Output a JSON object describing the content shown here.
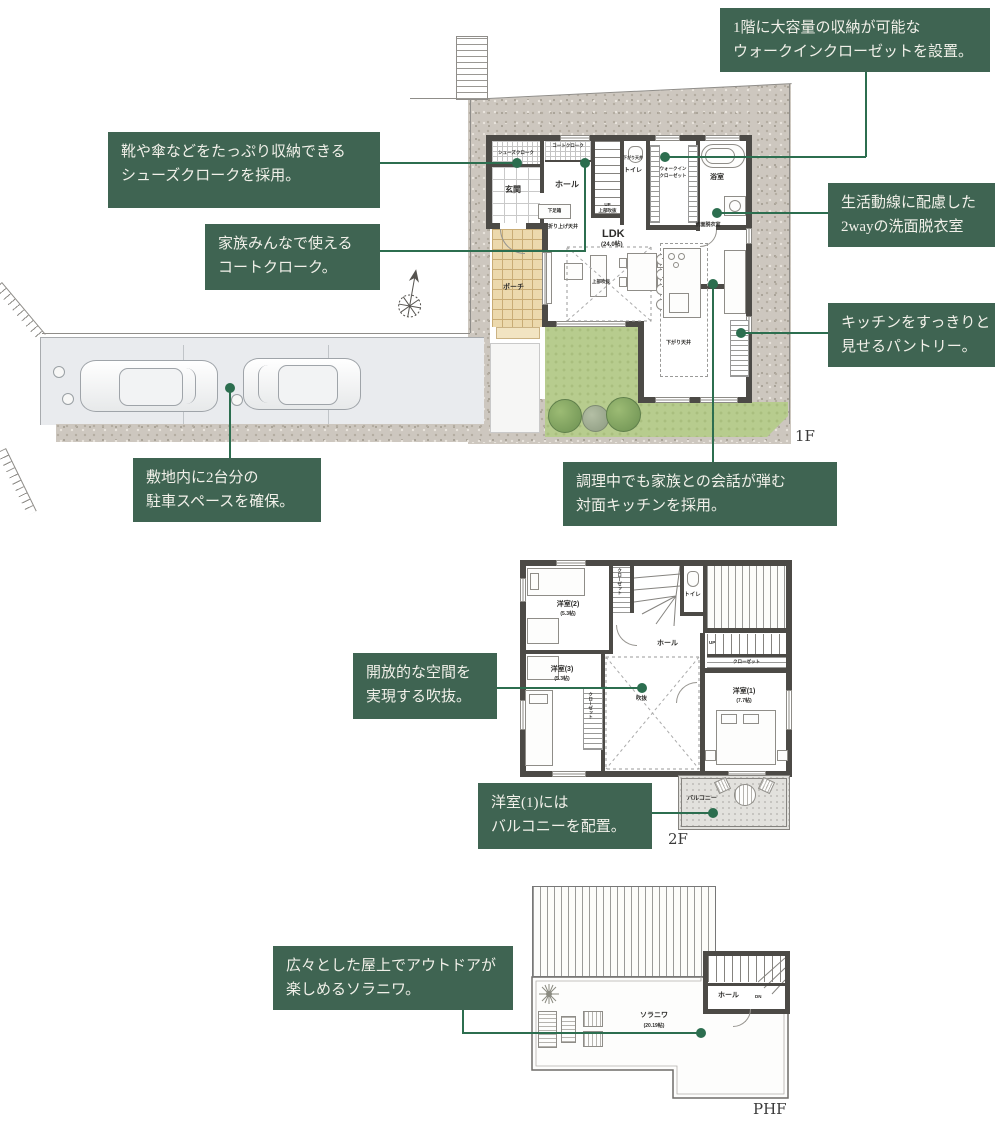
{
  "colors": {
    "accent_green": "#3f6452",
    "line_green": "#2c6e4f",
    "wall": "#4c4a46",
    "lawn": "#b7cc8e"
  },
  "annotations": {
    "walkin": {
      "l1": "1階に大容量の収納が可能な",
      "l2": "ウォークインクローゼットを設置。"
    },
    "shoes": {
      "l1": "靴や傘などをたっぷり収納できる",
      "l2": "シューズクロークを採用。"
    },
    "coat": {
      "l1": "家族みんなで使える",
      "l2": "コートクローク。"
    },
    "washroom": {
      "l1": "生活動線に配慮した",
      "l2": "2wayの洗面脱衣室"
    },
    "pantry": {
      "l1": "キッチンをすっきりと",
      "l2": "見せるパントリー。"
    },
    "parking": {
      "l1": "敷地内に2台分の",
      "l2": "駐車スペースを確保。"
    },
    "kitchen": {
      "l1": "調理中でも家族との会話が弾む",
      "l2": "対面キッチンを採用。"
    },
    "void": {
      "l1": "開放的な空間を",
      "l2": "実現する吹抜。"
    },
    "balcony": {
      "l1": "洋室(1)には",
      "l2": "バルコニーを配置。"
    },
    "solaniwa": {
      "l1": "広々とした屋上でアウトドアが",
      "l2": "楽しめるソラニワ。"
    }
  },
  "f1": {
    "floor_label": "1F",
    "shoes_closet": "シューズクローク",
    "coat_closet": "コートクローク",
    "genkan": "玄関",
    "hall": "ホール",
    "shoe_box": "下足箱",
    "coffered": "折り上げ天井",
    "up": "UP",
    "stair_void": "上部吹抜",
    "toilet": "トイレ",
    "toilet_ceiling": "下がり天井",
    "wic1": "ウォークイン",
    "wic2": "クローゼット",
    "bath": "浴室",
    "washroom": "洗面脱衣室",
    "ldk": "LDK",
    "ldk_size": "(24.0帖)",
    "living_void": "上部吹抜",
    "dropped": "下がり天井",
    "porch": "ポーチ"
  },
  "f2": {
    "floor_label": "2F",
    "room2": "洋室(2)",
    "room2_size": "(5.3帖)",
    "room3": "洋室(3)",
    "room3_size": "(5.3帖)",
    "room1": "洋室(1)",
    "room1_size": "(7.7帖)",
    "closet1": "クローゼット",
    "closet2": "クローゼット",
    "closet3": "クローゼット",
    "toilet": "トイレ",
    "hall": "ホール",
    "up": "UP",
    "void": "吹抜",
    "balcony": "バルコニー"
  },
  "phf": {
    "floor_label": "PHF",
    "solaniwa": "ソラニワ",
    "solaniwa_size": "(20.19帖)",
    "hall": "ホール",
    "dn": "DN"
  }
}
